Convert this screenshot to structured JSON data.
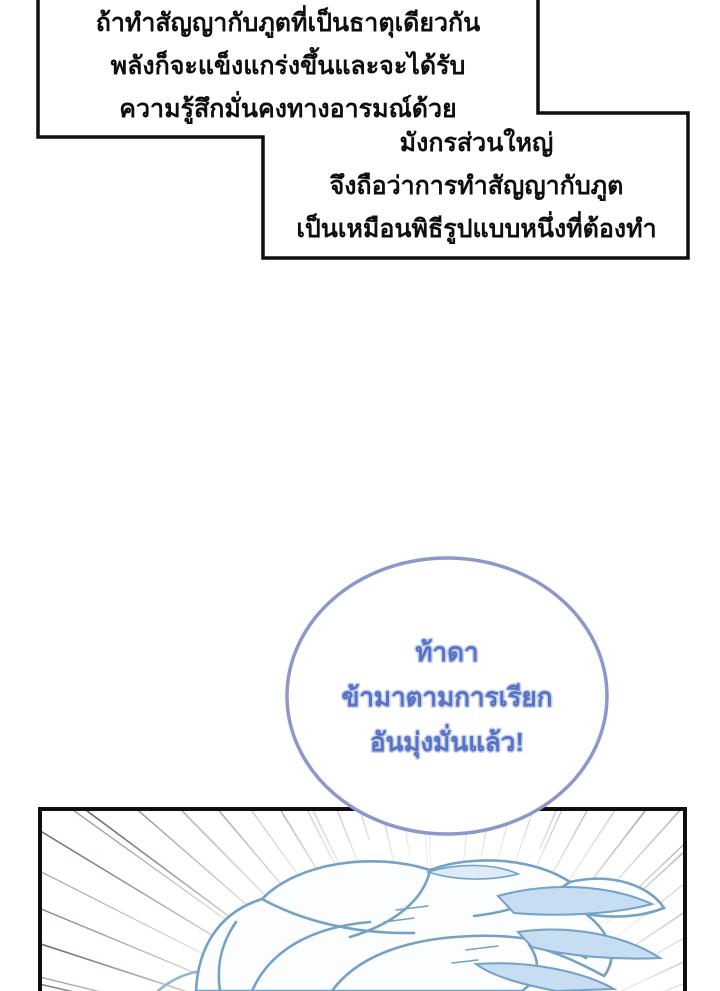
{
  "colors": {
    "page_bg": "#ffffff",
    "ink": "#0f0f0f",
    "bubble_border": "#8b97cd",
    "bubble_text": "#5873c4",
    "bubble_halo": "#c5d0ee",
    "speed_line": "#3a1c24",
    "hair_stroke": "#74a1c6",
    "hair_stroke_soft": "#8fb4d4",
    "hair_fill_light": "#fbfdff",
    "hair_fill_accent": "#c6ddf2",
    "hair_fill_pale": "#dcebf7"
  },
  "narration_box_top": {
    "lines": [
      "ถ้าทำสัญญากับภูตที่เป็นธาตุเดียวกัน",
      "พลังก็จะแข็งแกร่งขึ้นและจะได้รับ",
      "ความรู้สึกมั่นคงทางอารมณ์ด้วย"
    ]
  },
  "narration_box_bottom": {
    "lines": [
      "มังกรส่วนใหญ่",
      "จึงถือว่าการทำสัญญากับภูต",
      "เป็นเหมือนพิธีรูปแบบหนึ่งที่ต้องทำ"
    ]
  },
  "speech_bubble": {
    "lines": [
      "ท้าดา",
      "ข้ามาตามการเรียก",
      "อันมุ่งมั่นแล้ว!"
    ]
  },
  "artwork": {
    "speed_line_count": 40
  }
}
